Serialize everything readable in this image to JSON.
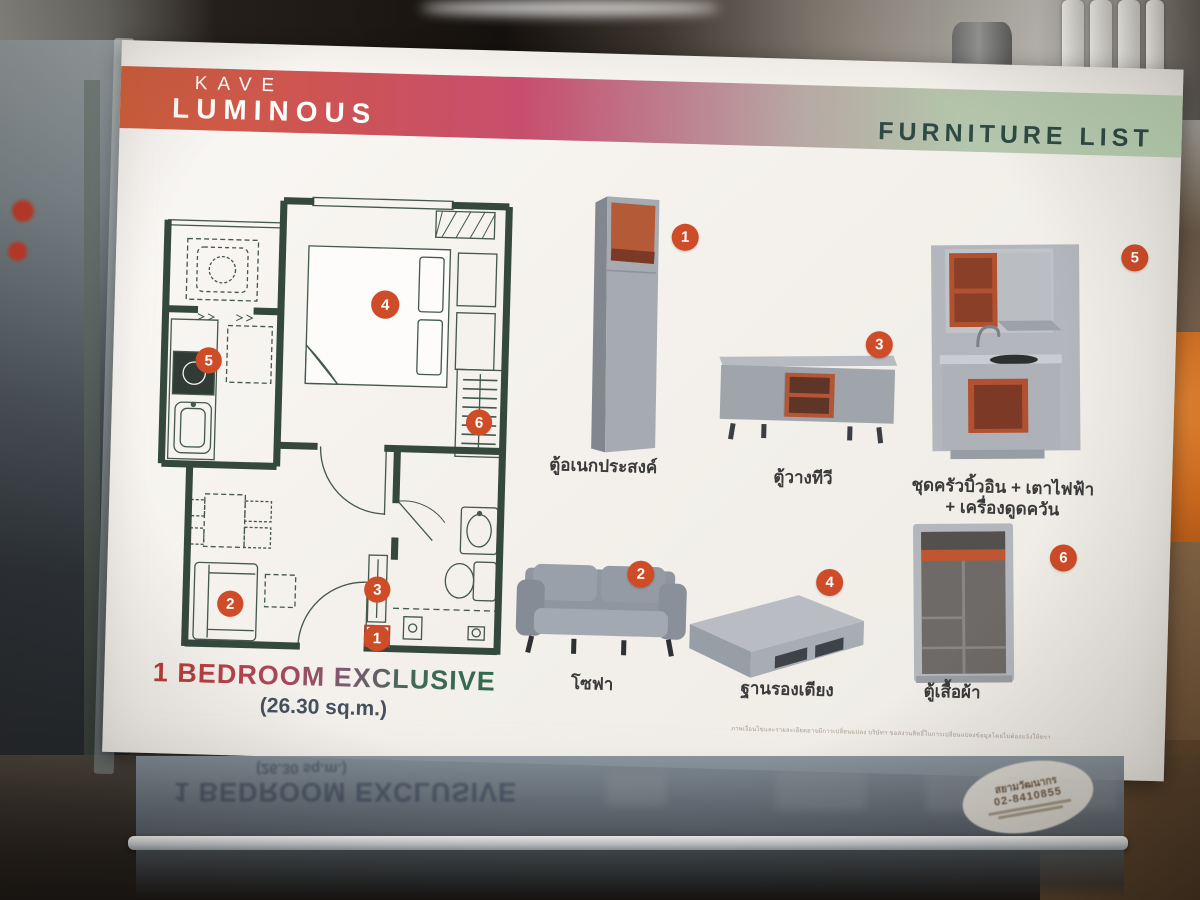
{
  "card": {
    "brand_top": "KAVE",
    "brand_bottom": "LUMINOUS",
    "header": "FURNITURE LIST",
    "plan_title": "1 BEDROOM EXCLUSIVE",
    "plan_area": "(26.30 sq.m.)",
    "plan_markers": [
      "1",
      "2",
      "3",
      "4",
      "5",
      "6"
    ],
    "furniture": [
      {
        "num": "1",
        "label": "ตู้อเนกประสงค์"
      },
      {
        "num": "2",
        "label": "โซฟา"
      },
      {
        "num": "3",
        "label": "ตู้วางทีวี"
      },
      {
        "num": "4",
        "label": "ฐานรองเตียง"
      },
      {
        "num": "5",
        "label": "ชุดครัวบิ้วอิน + เตาไฟฟ้า",
        "label2": "+ เครื่องดูดควัน"
      },
      {
        "num": "6",
        "label": "ตู้เสื้อผ้า"
      }
    ],
    "disclaimer": "ภาพเงื่อนไขและรายละเอียดอาจมีการเปลี่ยนแปลง บริษัทฯ ขอสงวนสิทธิ์ในการเปลี่ยนแปลงข้อมูลโดยไม่ต้องแจ้งให้ทราบล่วงหน้า",
    "colors": {
      "band_left": "#d2603c",
      "band_right": "#bdd5b6",
      "badge": "#cf4c28",
      "wall": "#35483e",
      "accent_orange": "#b25130",
      "furniture_gray": "#a2a7ad"
    }
  },
  "sticker": {
    "name": "สยามวัฒนากร",
    "phone": "02-8410855"
  }
}
